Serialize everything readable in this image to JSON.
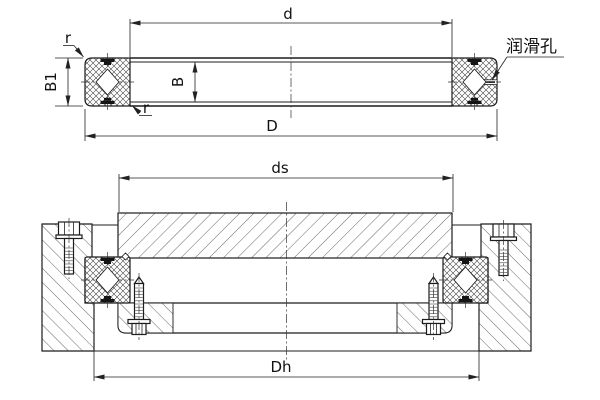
{
  "drawing": {
    "background": "#ffffff",
    "line_color": "#1c1c1c",
    "hatch_color": "#404040",
    "seal_color": "#151515",
    "top_view": {
      "dim_d": "d",
      "dim_D": "D",
      "dim_B": "B",
      "dim_B1": "B1",
      "fillet_r_top": "r",
      "fillet_r_bottom": "r",
      "lubrication_hole_label": "润滑孔"
    },
    "bottom_view": {
      "dim_ds": "ds",
      "dim_Dh": "Dh"
    }
  }
}
